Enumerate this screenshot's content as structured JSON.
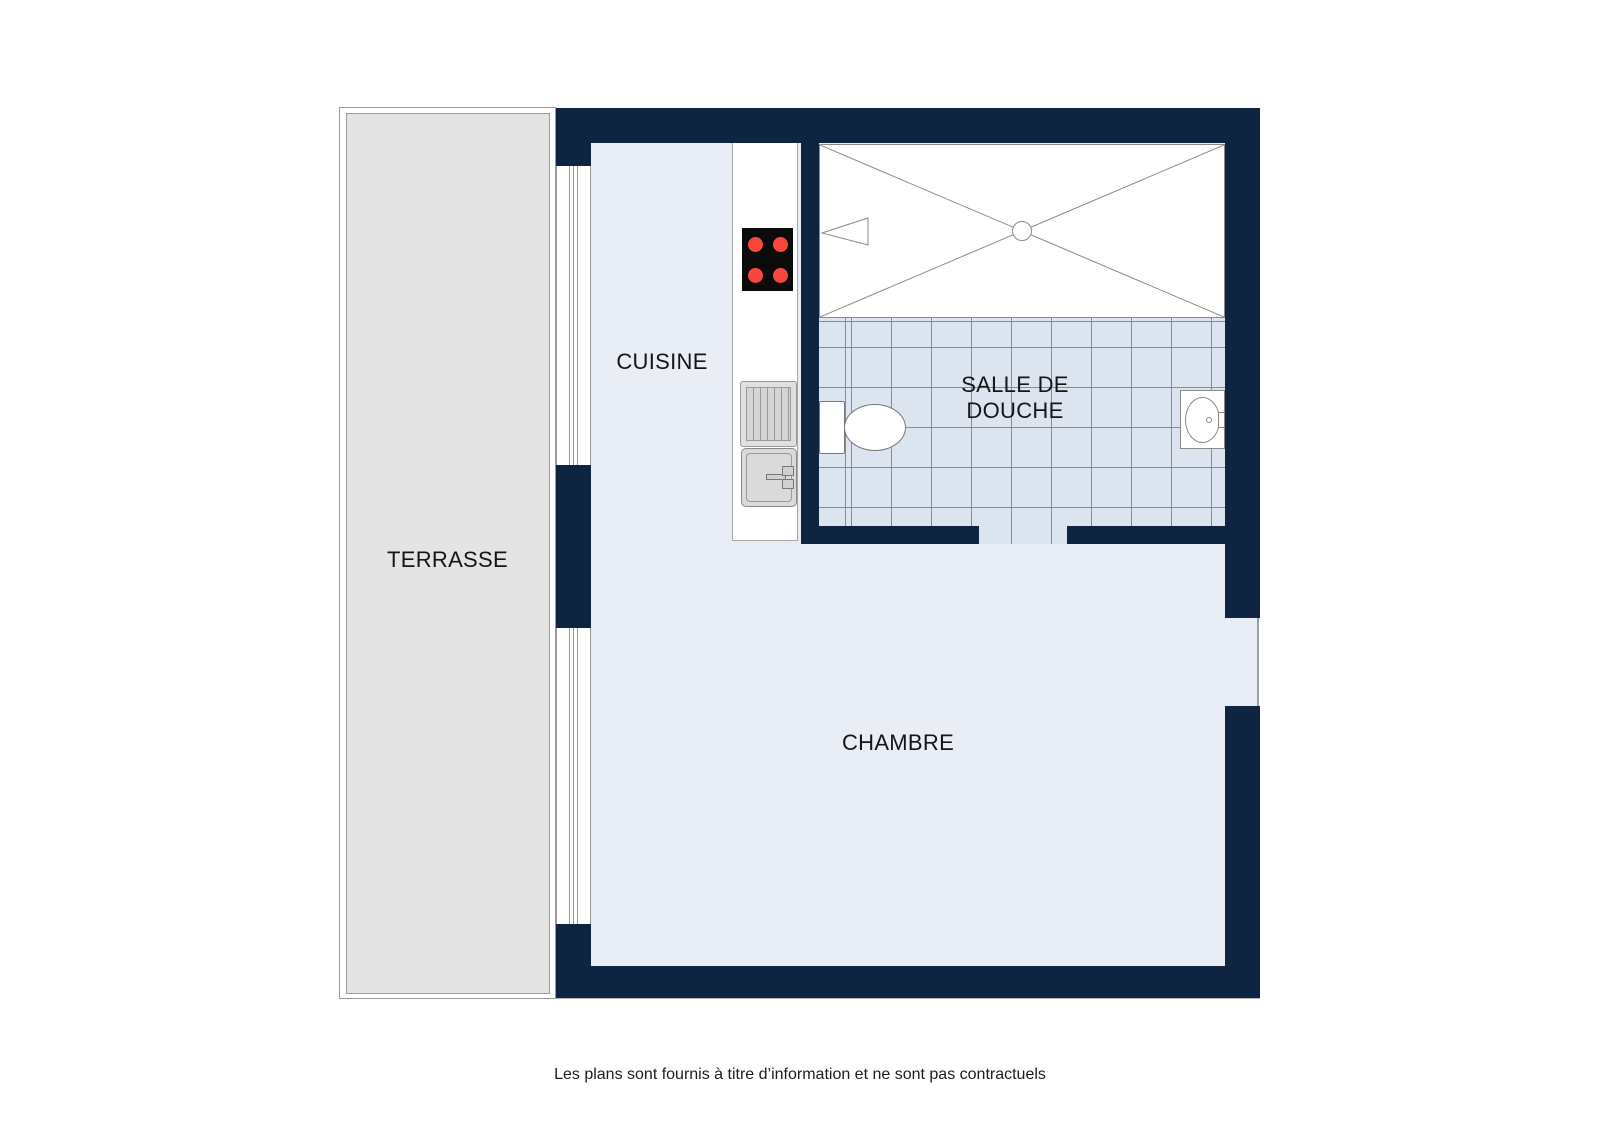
{
  "rooms": {
    "terrasse": {
      "label": "TERRASSE"
    },
    "cuisine": {
      "label": "CUISINE"
    },
    "salle_de_douche": {
      "label": "SALLE DE DOUCHE"
    },
    "chambre": {
      "label": "CHAMBRE"
    }
  },
  "fixtures": {
    "stove": "4-burner-hob",
    "drainer": "dish-drainer",
    "kitchen_sink": "kitchen-sink-with-faucet",
    "toilet": "toilet",
    "washbasin": "washbasin",
    "shower": "shower-tray-with-drain"
  },
  "footer": {
    "disclaimer": "Les plans sont fournis à titre d’information et ne sont pas contractuels"
  },
  "colors": {
    "wall": "#0f2440",
    "floor": "#e8edf6",
    "tile": "#dce4f0",
    "tileline": "#7e8ca2",
    "terrace": "#e4e4e4",
    "outline": "#8a8a8a",
    "burner": "#f9473d",
    "text": "#151515"
  }
}
